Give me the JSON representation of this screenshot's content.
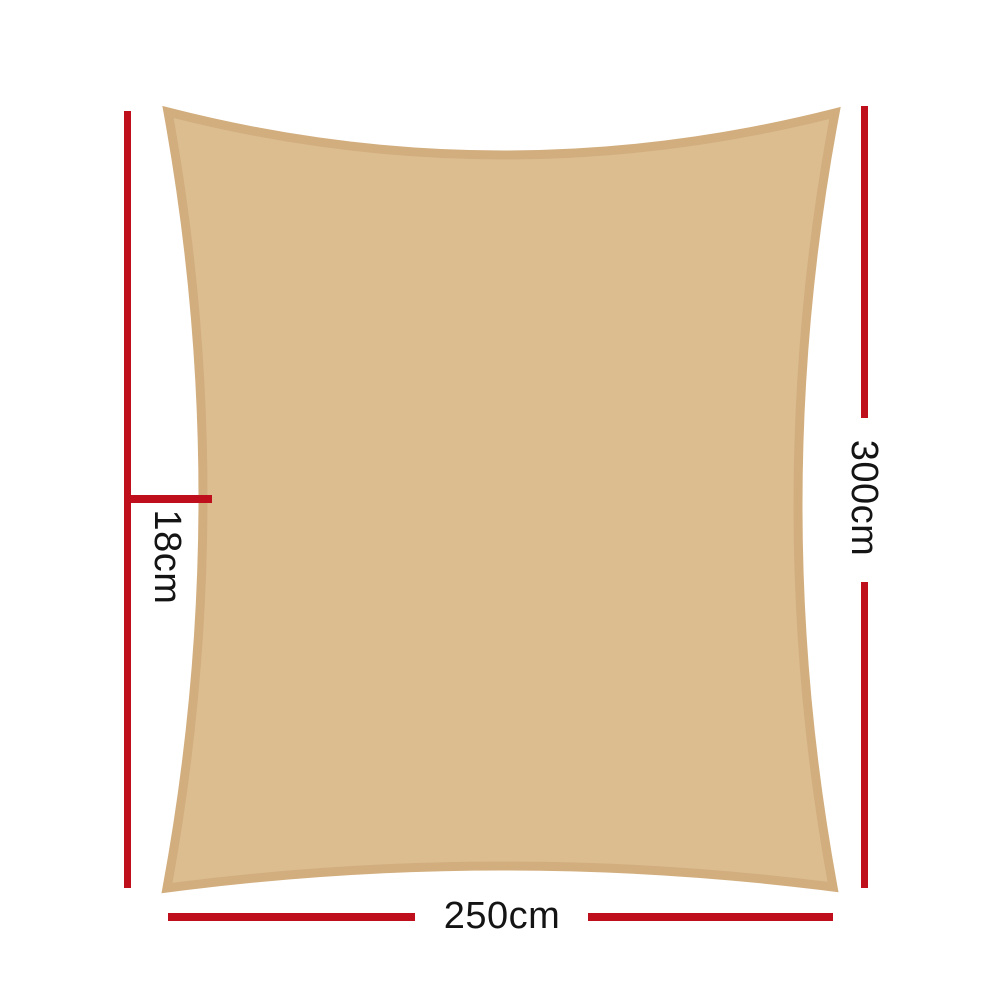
{
  "colors": {
    "sail-fill": "#dcbd90",
    "sail-border": "#d2ae7e",
    "dimension-line": "#c00f1c",
    "label-text": "#141414"
  },
  "diagram": {
    "height_label": "300cm",
    "width_label": "250cm",
    "curve_depth_label": "18cm"
  }
}
